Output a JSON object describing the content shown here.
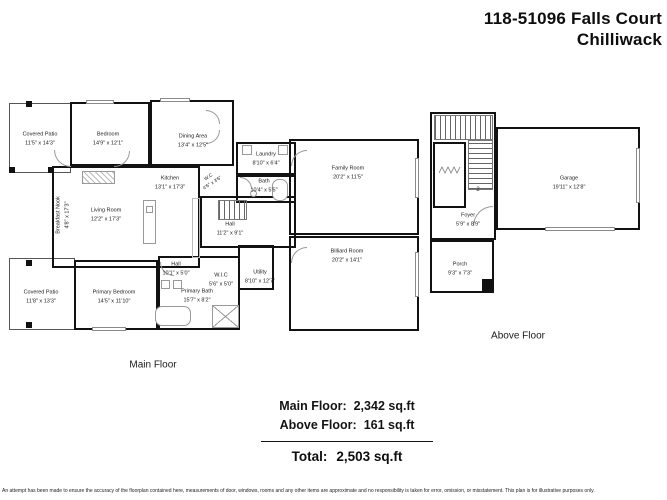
{
  "header": {
    "title_line1": "118-51096 Falls Court",
    "title_line2": "Chilliwack"
  },
  "main_floor": {
    "caption": "Main Floor",
    "rooms": {
      "covered_patio_top": {
        "name": "Covered Patio",
        "dims": "11'5\" x 14'3\""
      },
      "bedroom": {
        "name": "Bedroom",
        "dims": "14'9\" x 12'1\""
      },
      "dining_area": {
        "name": "Dining Area",
        "dims": "13'4\" x 12'5\""
      },
      "kitchen": {
        "name": "Kitchen",
        "dims": "13'1\" x 17'3\""
      },
      "living_room": {
        "name": "Living Room",
        "dims": "12'2\" x 17'3\""
      },
      "breakfast_nook": {
        "name": "Breakfast Nook",
        "dims": "4'8\" x 17'3\""
      },
      "laundry": {
        "name": "Laundry",
        "dims": "8'10\" x 6'4\""
      },
      "bath": {
        "name": "Bath",
        "dims": "10'4\" x 5'5\""
      },
      "wc": {
        "name": "W.C",
        "dims": "4'6\" x 3'6\""
      },
      "hall": {
        "name": "Hall",
        "dims": "11'2\" x 9'1\""
      },
      "family_room": {
        "name": "Family Room",
        "dims": "20'2\" x 11'5\""
      },
      "billiard_room": {
        "name": "Billiard Room",
        "dims": "20'2\" x 14'1\""
      },
      "utility": {
        "name": "Utility",
        "dims": "8'10\" x 12'7\""
      },
      "covered_patio_bottom": {
        "name": "Covered Patio",
        "dims": "11'8\" x 13'3\""
      },
      "primary_bedroom": {
        "name": "Primary Bedroom",
        "dims": "14'5\" x 11'10\""
      },
      "hall_lower": {
        "name": "Hall",
        "dims": "10'1\" x 5'0\""
      },
      "wic": {
        "name": "W.I.C",
        "dims": "5'6\" x 5'0\""
      },
      "primary_bath": {
        "name": "Primary Bath",
        "dims": "15'7\" x 8'2\""
      }
    }
  },
  "above_floor": {
    "caption": "Above Floor",
    "stair_label": "2",
    "rooms": {
      "garage": {
        "name": "Garage",
        "dims": "19'11\" x 12'8\""
      },
      "foyer": {
        "name": "Foyer",
        "dims": "5'9\" x 8'9\""
      },
      "porch": {
        "name": "Porch",
        "dims": "9'3\" x 7'3\""
      }
    }
  },
  "summary": {
    "main_floor_label": "Main Floor:",
    "main_floor_value": "2,342 sq.ft",
    "above_floor_label": "Above Floor:",
    "above_floor_value": "161 sq.ft",
    "total_label": "Total:",
    "total_value": "2,503 sq.ft"
  },
  "disclaimer": "An attempt has been made to ensure the accuracy of the floorplan contained here, measurements of door, windows, rooms and any other items are approximate and no responsibility is taken for error, omission, or misstatement. This plan is for illustrative purposes only."
}
